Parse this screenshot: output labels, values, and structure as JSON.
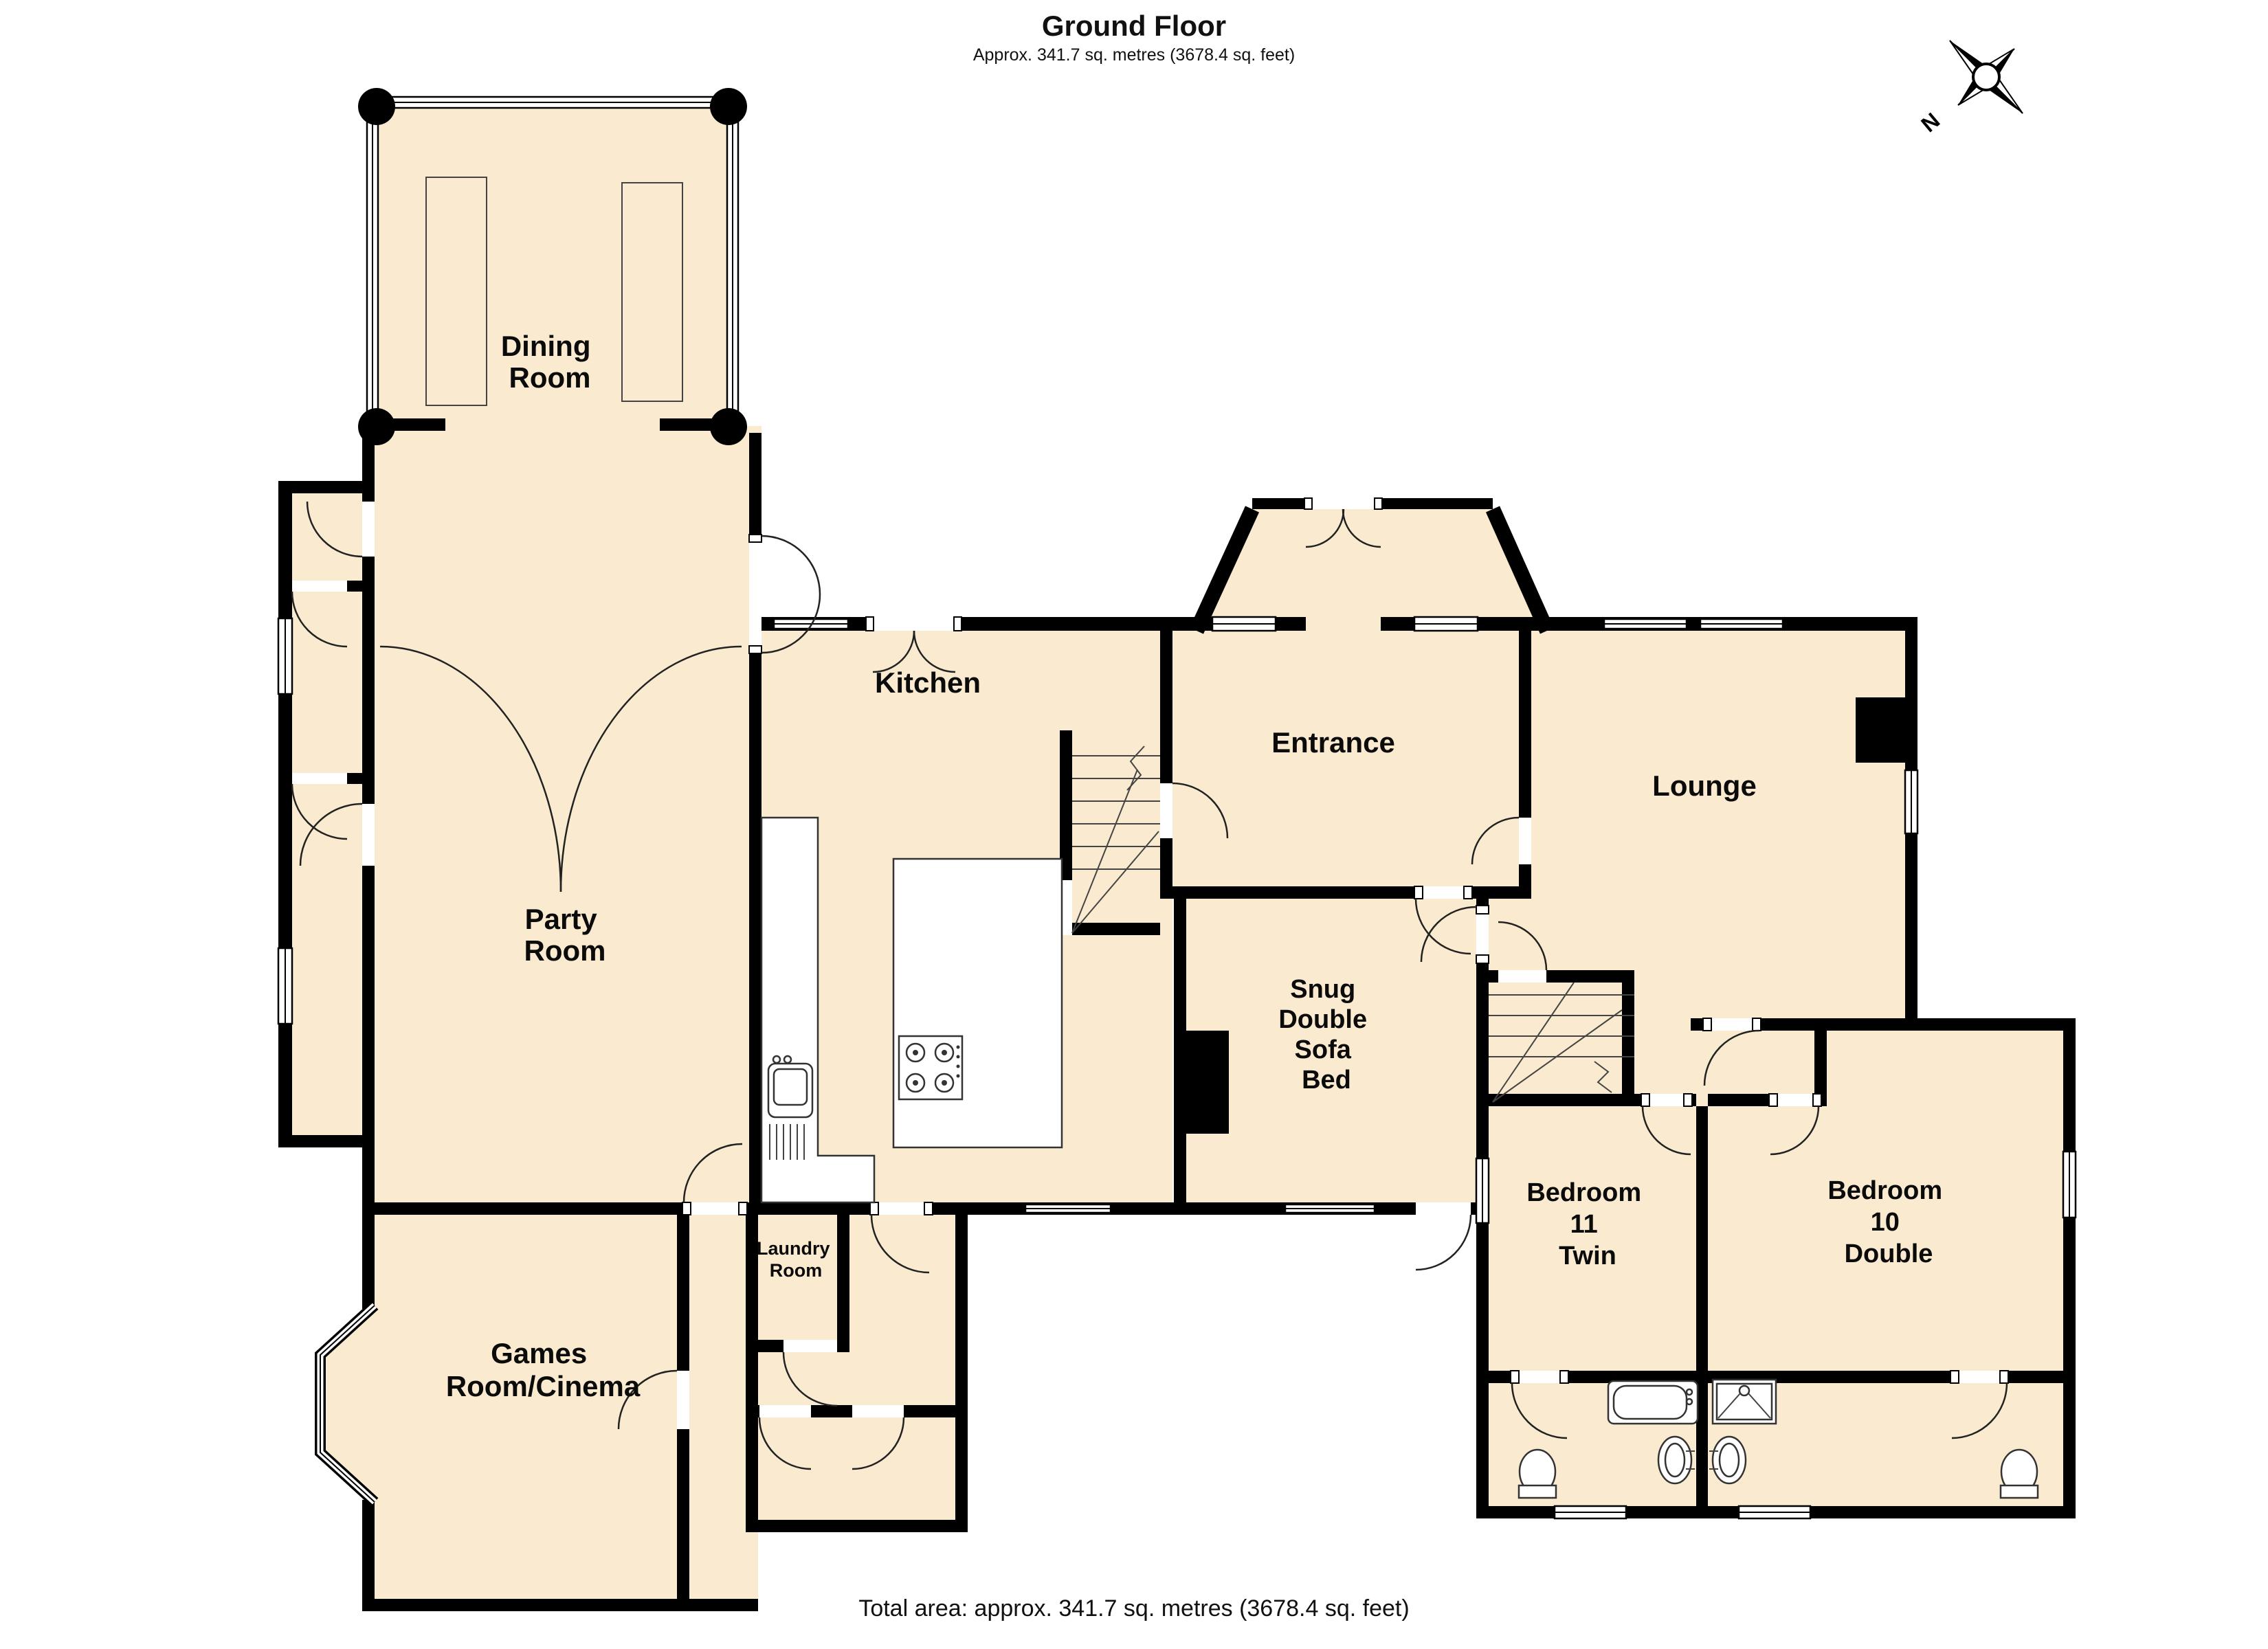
{
  "title": {
    "heading": "Ground Floor",
    "subtitle": "Approx. 341.7 sq. metres (3678.4 sq. feet)"
  },
  "footer": {
    "total_area": "Total area: approx. 341.7 sq. metres (3678.4 sq. feet)"
  },
  "compass": {
    "label": "N"
  },
  "colors": {
    "room_fill": "#FAEACF",
    "wall": "#000000",
    "fixture_stroke": "#333333"
  },
  "rooms": {
    "dining": {
      "lines": [
        "Dining",
        "Room"
      ]
    },
    "party": {
      "lines": [
        "Party",
        "Room"
      ]
    },
    "kitchen": {
      "lines": [
        "Kitchen"
      ]
    },
    "entrance": {
      "lines": [
        "Entrance"
      ]
    },
    "lounge": {
      "lines": [
        "Lounge"
      ]
    },
    "snug": {
      "lines": [
        "Snug",
        "Double",
        "Sofa",
        "Bed"
      ]
    },
    "bedroom11": {
      "lines": [
        "Bedroom",
        "11",
        "Twin"
      ]
    },
    "bedroom10": {
      "lines": [
        "Bedroom",
        "10",
        "Double"
      ]
    },
    "laundry": {
      "lines": [
        "Laundry",
        "Room"
      ]
    },
    "games": {
      "lines": [
        "Games",
        "Room/Cinema"
      ]
    }
  }
}
